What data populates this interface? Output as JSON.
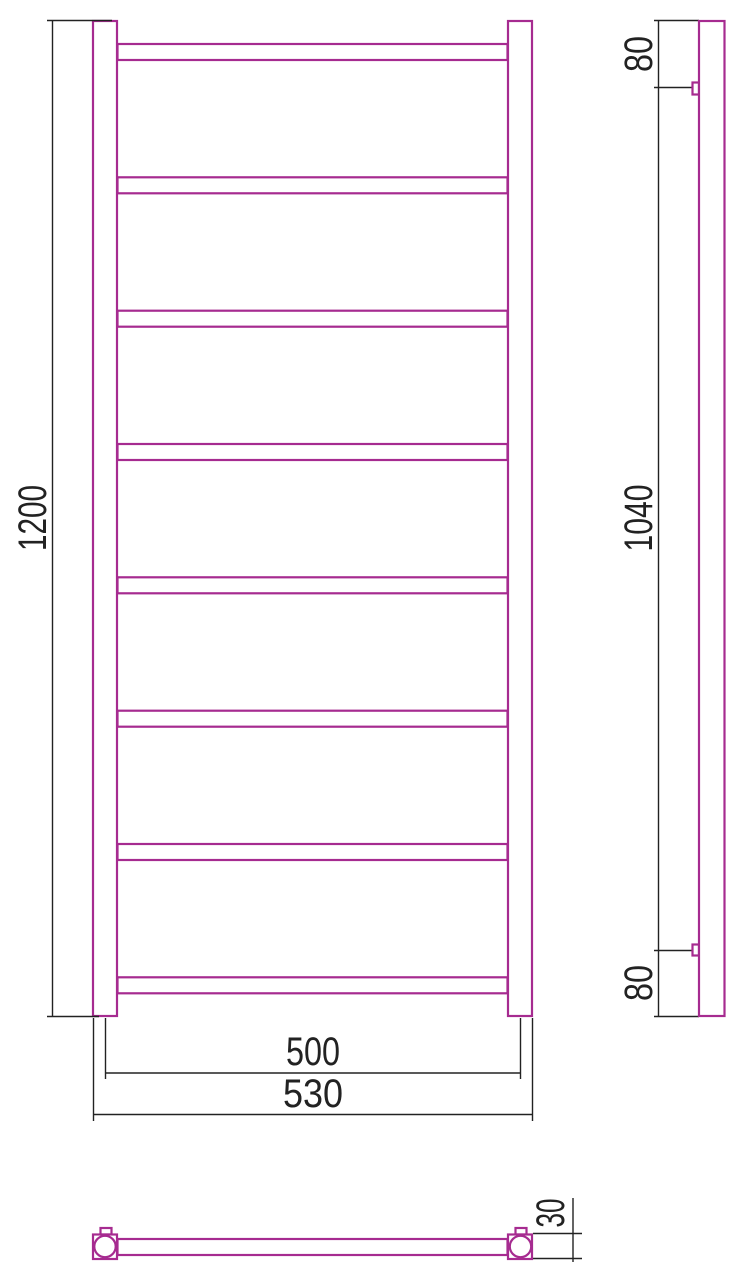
{
  "drawing": {
    "kind": "ladder-towel-rail-technical-drawing",
    "units": "mm",
    "rung_count": 8,
    "colors": {
      "product_outline": "#A62B90",
      "dimension_lines": "#222222",
      "background": "#FFFFFF"
    }
  },
  "front_view": {
    "dimensions": {
      "height": "1200",
      "rail_pitch_width": "500",
      "overall_width": "530"
    }
  },
  "side_view": {
    "dimensions": {
      "top_bracket_offset": "80",
      "bracket_spacing": "1040",
      "bottom_bracket_offset": "80"
    }
  },
  "top_view": {
    "dimensions": {
      "depth": "30"
    }
  }
}
